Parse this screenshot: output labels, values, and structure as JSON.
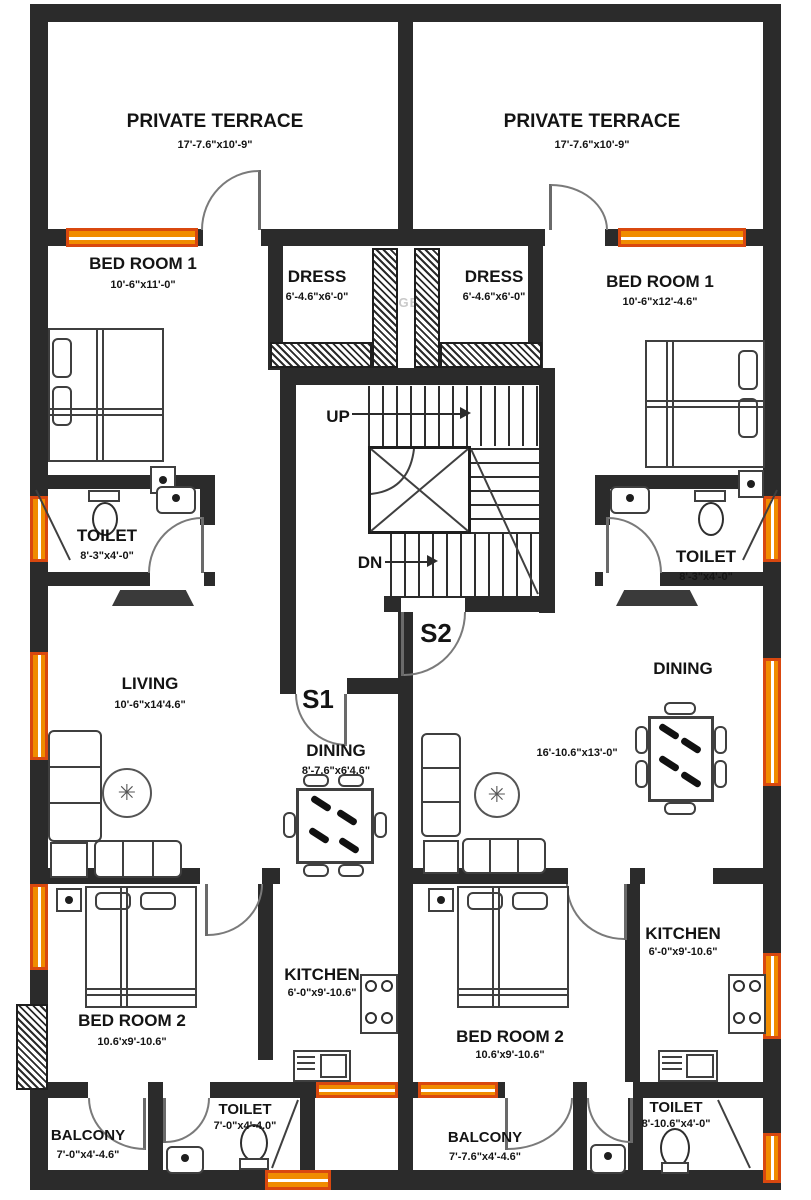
{
  "watermark": "TIGER",
  "stair": {
    "up": "UP",
    "dn": "DN"
  },
  "doors": {
    "s1": "S1",
    "s2": "S2"
  },
  "colors": {
    "wall": "#2b2b2b",
    "window_fill": "#f08c00",
    "window_frame": "#d9480f"
  },
  "rooms": {
    "terrace_left": {
      "name": "PRIVATE TERRACE",
      "dim": "17'-7.6\"x10'-9\""
    },
    "terrace_right": {
      "name": "PRIVATE TERRACE",
      "dim": "17'-7.6\"x10'-9\""
    },
    "bedroom1_left": {
      "name": "BED ROOM 1",
      "dim": "10'-6\"x11'-0\""
    },
    "dress_left": {
      "name": "DRESS",
      "dim": "6'-4.6\"x6'-0\""
    },
    "dress_right": {
      "name": "DRESS",
      "dim": "6'-4.6\"x6'-0\""
    },
    "bedroom1_right": {
      "name": "BED ROOM 1",
      "dim": "10'-6\"x12'-4.6\""
    },
    "toilet_left": {
      "name": "TOILET",
      "dim": "8'-3\"x4'-0\""
    },
    "toilet_right": {
      "name": "TOILET",
      "dim": "8'-3\"x4'-0\""
    },
    "living_left": {
      "name": "LIVING",
      "dim": "10'-6\"x14'4.6\""
    },
    "dining_left": {
      "name": "DINING",
      "dim": "8'-7.6\"x6'4.6\""
    },
    "dining_right": {
      "name": "DINING",
      "dim": "16'-10.6\"x13'-0\""
    },
    "bedroom2_left": {
      "name": "BED ROOM 2",
      "dim": "10.6'x9'-10.6\""
    },
    "kitchen_left": {
      "name": "KITCHEN",
      "dim": "6'-0\"x9'-10.6\""
    },
    "bedroom2_right": {
      "name": "BED ROOM 2",
      "dim": "10.6'x9'-10.6\""
    },
    "kitchen_right": {
      "name": "KITCHEN",
      "dim": "6'-0\"x9'-10.6\""
    },
    "balcony_left": {
      "name": "BALCONY",
      "dim": "7'-0\"x4'-4.6\""
    },
    "toilet_b_left": {
      "name": "TOILET",
      "dim": "7'-0\"x4'-4.0\""
    },
    "balcony_right": {
      "name": "BALCONY",
      "dim": "7'-7.6\"x4'-4.6\""
    },
    "toilet_b_right": {
      "name": "TOILET",
      "dim": "8'-10.6\"x4'-0\""
    }
  }
}
